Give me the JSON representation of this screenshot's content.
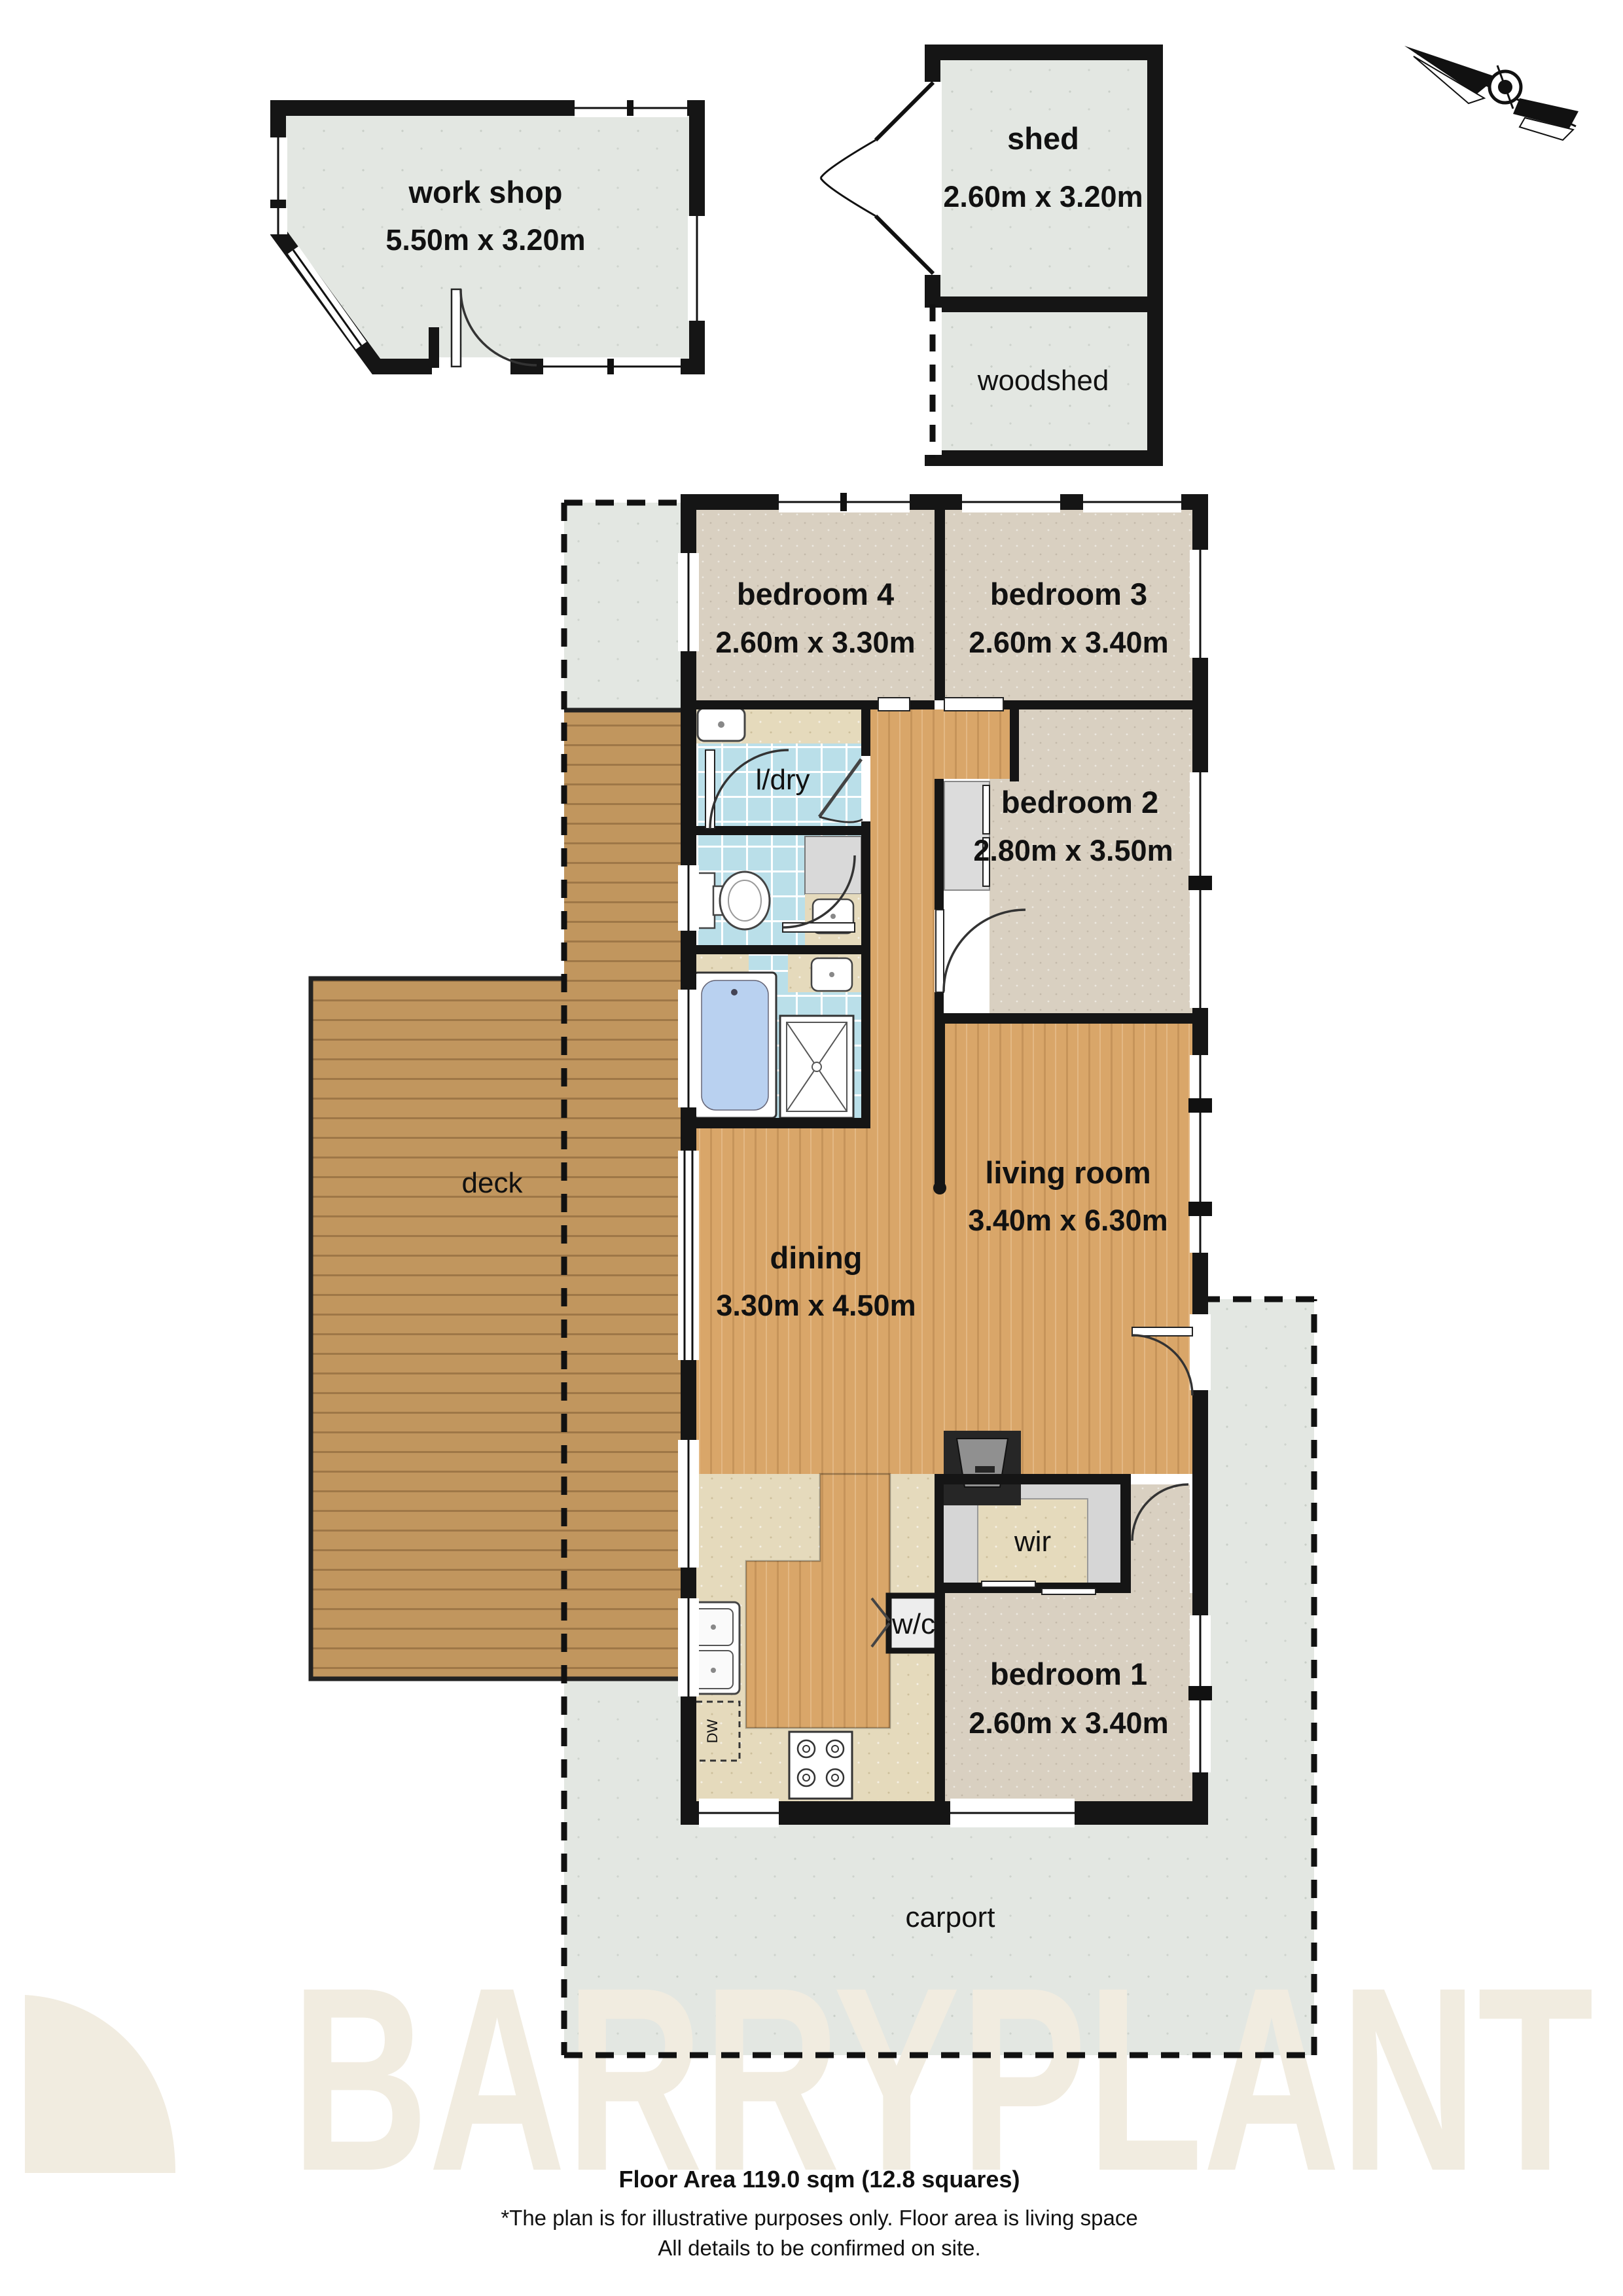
{
  "plan_title": "Residential floor plan",
  "rooms": {
    "workshop": {
      "name": "work shop",
      "dims": "5.50m x 3.20m"
    },
    "shed": {
      "name": "shed",
      "dims": "2.60m x 3.20m"
    },
    "woodshed": {
      "name": "woodshed"
    },
    "bedroom4": {
      "name": "bedroom 4",
      "dims": "2.60m x 3.30m"
    },
    "bedroom3": {
      "name": "bedroom 3",
      "dims": "2.60m x 3.40m"
    },
    "bedroom2": {
      "name": "bedroom 2",
      "dims": "2.80m x 3.50m"
    },
    "bedroom1": {
      "name": "bedroom 1",
      "dims": "2.60m x 3.40m"
    },
    "living": {
      "name": "living room",
      "dims": "3.40m x 6.30m"
    },
    "dining": {
      "name": "dining",
      "dims": "3.30m x 4.50m"
    },
    "laundry": {
      "name": "l/dry"
    },
    "wir": {
      "name": "wir"
    },
    "wc": {
      "name": "w/c"
    },
    "deck": {
      "name": "deck"
    },
    "carport": {
      "name": "carport"
    },
    "dishwasher": {
      "name": "DW"
    }
  },
  "footer": {
    "floor_area": "Floor Area 119.0 sqm (12.8 squares)",
    "disclaimer_line1": "*The plan is for illustrative purposes only. Floor area is living space",
    "disclaimer_line2": "All details to be confirmed on site."
  },
  "watermark": {
    "text": "BARRYPLANT"
  },
  "colors": {
    "wall": "#151515",
    "carpet": "#d9d0c1",
    "wood_floor": "#d9a669",
    "deck_wood": "#c1965e",
    "tile": "#badfe9",
    "counter": "#e5dabc",
    "outbuilding_floor": "#e3e7e2",
    "carport_concrete": "#e5e8e5",
    "robe_gray": "#dcdcdc",
    "watermark_cream": "#f1ece0"
  }
}
